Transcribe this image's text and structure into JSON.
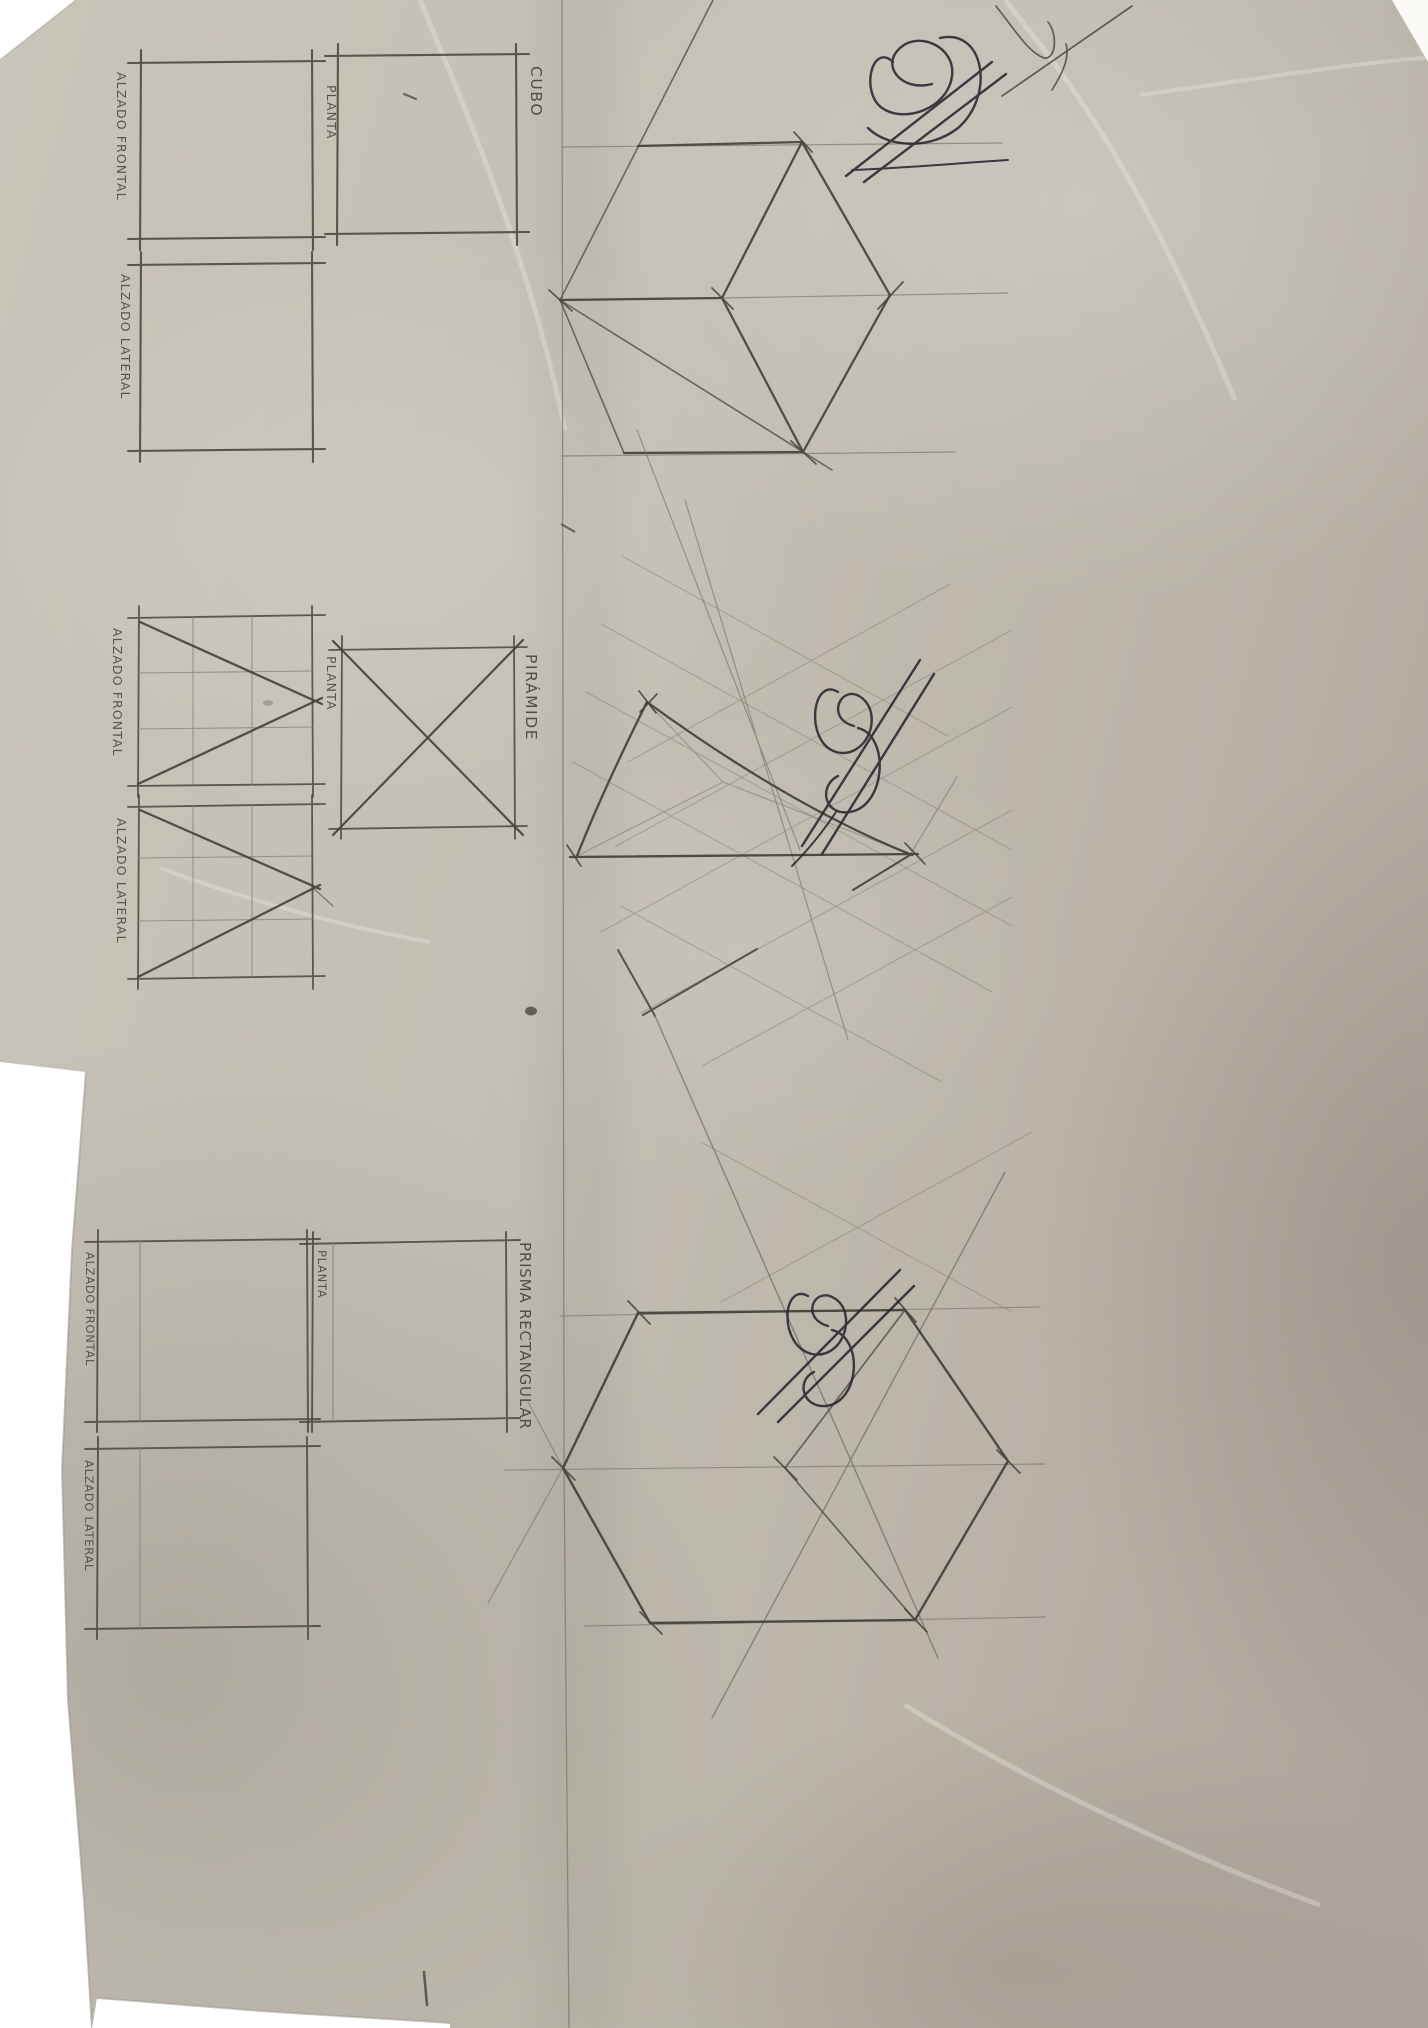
{
  "document_type": "hand-drawn technical drawing exercise, photographed on paper",
  "sections": {
    "cubo": {
      "title": "CUBO",
      "views": {
        "frontal": "ALZADO FRONTAL",
        "planta": "PLANTA",
        "lateral": "ALZADO LATERAL"
      }
    },
    "piramide": {
      "title": "PIRÁMIDE",
      "views": {
        "frontal": "ALZADO FRONTAL",
        "planta": "PLANTA",
        "lateral": "ALZADO LATERAL"
      }
    },
    "prisma": {
      "title": "PRISMA RECTANGULAR",
      "views": {
        "frontal": "ALZADO FRONTAL",
        "planta": "PLANTA",
        "lateral": "ALZADO LATERAL"
      }
    }
  },
  "colors": {
    "background": "#ffffff",
    "paper": "#c0bab0",
    "pencil_dark": "#44403a",
    "pencil_medium": "#5b564d",
    "pencil_light": "#7f7970",
    "pencil_faint": "#8d877b",
    "ink": "#2a2530",
    "label": "#45413a"
  }
}
